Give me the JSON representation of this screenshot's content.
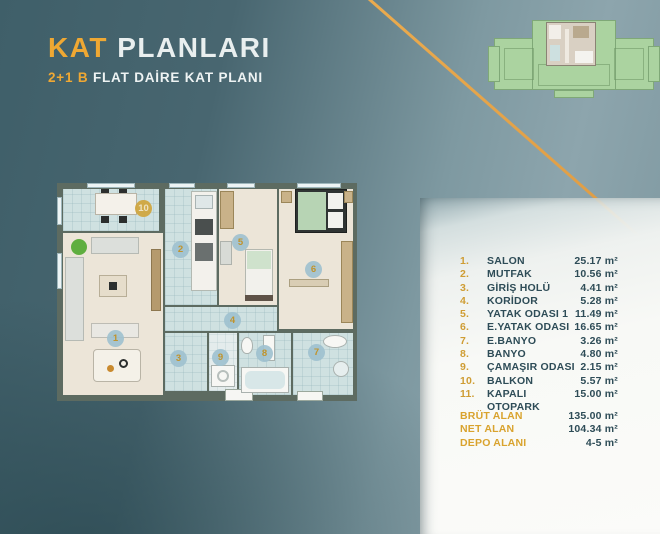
{
  "header": {
    "title_highlight": "KAT",
    "title_rest": " PLANLARI",
    "subtitle_highlight": "2+1 B",
    "subtitle_rest": " FLAT DAİRE KAT PLANI"
  },
  "rooms": [
    {
      "num": "1.",
      "label": "SALON",
      "area": "25.17 m²"
    },
    {
      "num": "2.",
      "label": "MUTFAK",
      "area": "10.56 m²"
    },
    {
      "num": "3.",
      "label": "GİRİŞ HOLÜ",
      "area": "4.41 m²"
    },
    {
      "num": "4.",
      "label": "KORİDOR",
      "area": "5.28 m²"
    },
    {
      "num": "5.",
      "label": "YATAK ODASI 1",
      "area": "11.49 m²"
    },
    {
      "num": "6.",
      "label": "E.YATAK ODASI",
      "area": "16.65 m²"
    },
    {
      "num": "7.",
      "label": "E.BANYO",
      "area": "3.26 m²"
    },
    {
      "num": "8.",
      "label": "BANYO",
      "area": "4.80 m²"
    },
    {
      "num": "9.",
      "label": "ÇAMAŞIR ODASI",
      "area": "2.15 m²"
    },
    {
      "num": "10.",
      "label": "BALKON",
      "area": "5.57 m²"
    },
    {
      "num": "11.",
      "label": "KAPALI OTOPARK",
      "area": "15.00 m²"
    }
  ],
  "summary": [
    {
      "label": "BRÜT ALAN",
      "value": "135.00 m²"
    },
    {
      "label": "NET ALAN",
      "value": "104.34 m²"
    },
    {
      "label": "DEPO ALANI",
      "value": "4-5 m²"
    }
  ],
  "plan": {
    "markers": [
      "1",
      "2",
      "3",
      "4",
      "5",
      "6",
      "7",
      "8",
      "9",
      "10"
    ]
  },
  "colors": {
    "accent_orange": "#efa833",
    "list_gold": "#cf9d34",
    "text_dark": "#2e4c57",
    "background_teal": "#486670",
    "siteplan_green": "#abd3a0"
  }
}
